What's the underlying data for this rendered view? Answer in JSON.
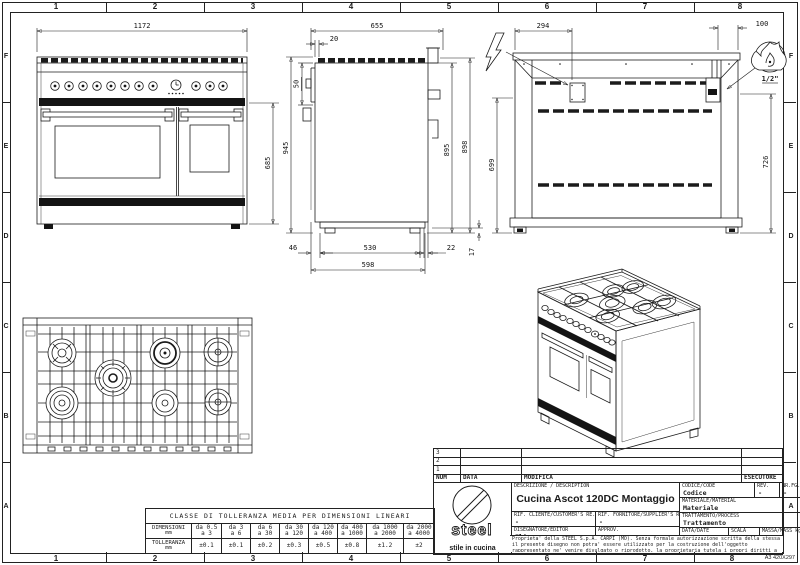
{
  "sheet": {
    "format": "A3 420X297",
    "grid_columns": [
      "1",
      "2",
      "3",
      "4",
      "5",
      "6",
      "7",
      "8"
    ],
    "grid_rows": [
      "F",
      "E",
      "D",
      "C",
      "B",
      "A"
    ]
  },
  "dimensions": {
    "front": {
      "width": "1172",
      "door_height": "685"
    },
    "side": {
      "depth": "655",
      "grate_inset": "20",
      "panel_height": "50",
      "total_height": "945",
      "body_height": "895",
      "grate_height": "898",
      "front_offset": "46",
      "foot_span": "530",
      "rear_offset": "22",
      "base_depth": "598",
      "foot_height": "17"
    },
    "rear": {
      "elec_offset": "294",
      "gas_offset": "100",
      "elec_height": "699",
      "gas_height": "726"
    }
  },
  "symbols": {
    "gas_connection_size": "1/2\""
  },
  "tolerance_table": {
    "title": "CLASSE DI TOLLERANZA MEDIA PER DIMENSIONI LINEARI",
    "row1_label": "DIMENSIONI",
    "row1_unit": "mm",
    "row2_label": "TOLLERANZA",
    "row2_unit": "mm",
    "ranges": [
      [
        "da 0.5",
        "a 3"
      ],
      [
        "da 3",
        "a 6"
      ],
      [
        "da 6",
        "a 30"
      ],
      [
        "da 30",
        "a 120"
      ],
      [
        "da 120",
        "a 400"
      ],
      [
        "da 400",
        "a 1000"
      ],
      [
        "da 1000",
        "a 2000"
      ],
      [
        "da 2000",
        "a 4000"
      ]
    ],
    "tolerances": [
      "±0.1",
      "±0.1",
      "±0.2",
      "±0.3",
      "±0.5",
      "±0.8",
      "±1.2",
      "±2"
    ]
  },
  "revision_table": {
    "rows": [
      "3",
      "2",
      "1"
    ],
    "num_label": "NUM",
    "date_label": "DATA",
    "change_label": "MODIFICA",
    "executor_label": "ESECUTORE"
  },
  "title_block": {
    "logo_text": "steel",
    "logo_tagline": "stile in cucina",
    "description_label": "DESCRIZIONE / DESCRIPTION",
    "description": "Cucina Ascot 120DC Montaggio",
    "code_label": "CODICE/CODE",
    "code": "Codice",
    "rev_label": "REV.",
    "rev": "-",
    "sheet_no_label": "NR.FG.",
    "sheet_no": "-",
    "material_label": "MATERIALE/MATERIAL",
    "material": "Materiale",
    "customer_ref_label": "RIF. CLIENTE/CUSTOMER'S RE.",
    "customer_ref": "-",
    "supplier_ref_label": "RIF. FORNITORE/SUPPLIER'S RE.",
    "supplier_ref": "-",
    "process_label": "TRATTAMENTO/PROCESS",
    "process": "Trattamento",
    "editor_label": "DISEGNATORE/EDITOR",
    "editor": "Elia",
    "approval_label": "APPROV.",
    "approval": "-",
    "date_label": "DATA/DATE",
    "date": "30/05/2012",
    "scale_label": "SCALA",
    "scale": "1:10",
    "mass_label": "MASSA/MASS kg",
    "mass": "-",
    "legal": "Proprieta' della STEEL S.p.A. CARPI (MO). Senza formale autorizzazione scritta della stessa il presente disegno non potra' essere utilizzato per la costruzione dell'oggetto rappresentato ne' venire divulgato o riprodotto, la proprietaria tutela i propri diritti a rigore di legge."
  }
}
